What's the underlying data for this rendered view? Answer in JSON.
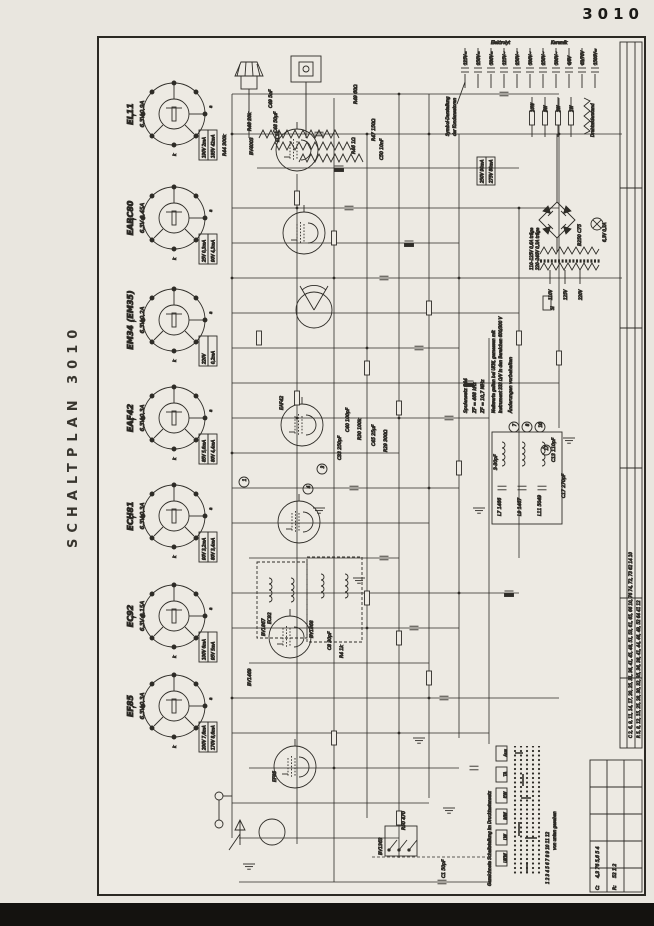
{
  "page": {
    "corner_number": "3010",
    "side_title": "SCHALTPLAN 3010"
  },
  "pins": {
    "f": "f",
    "k": "k",
    "a": "a"
  },
  "tubes": [
    {
      "name": "EL11",
      "heater": "6,3V 0,9A",
      "m1": "190V 2mA",
      "m2": "185V 42mA"
    },
    {
      "name": "EABC80",
      "heater": "6,3V 0,45A",
      "m1": "25V 0,3mA",
      "m2": "90V 4,3mA"
    },
    {
      "name": "EM34 (EM35)",
      "heater": "6,3V 0,2A",
      "m1": "220V",
      "m2": "0,2mA"
    },
    {
      "name": "EAF42",
      "heater": "6,3V 0,3A",
      "m1": "85V 5,6mA",
      "m2": "80V 4,4mA"
    },
    {
      "name": "ECH81",
      "heater": "6,3V 0,3A",
      "m1": "90V 3,2mA",
      "m2": "80V 3,4mA"
    },
    {
      "name": "EC92",
      "heater": "6,3V 0,15A",
      "m1": "100V 6mA",
      "m2": "95V 5mA"
    },
    {
      "name": "EF85",
      "heater": "6,3V 0,3A",
      "m1": "200V 7,6mA",
      "m2": "170V 8,6mA"
    }
  ],
  "legend": {
    "caps_title1": "Symbol-Darstellung",
    "caps_title2": "der Kondensatoren",
    "groups": [
      "Elektrolyt",
      "Keramik"
    ],
    "caps": [
      "125V=",
      "250V=",
      "500V=",
      "125V~",
      "250V~",
      "500V~",
      "250V~",
      "500V~",
      "6/8V",
      "63/70V",
      "1500V="
    ],
    "resistors": [
      "10W",
      "5W",
      "2W",
      "1W"
    ],
    "wire_resistor": "Drahtwiderstand"
  },
  "notes": {
    "spulensatz": "Spulensatz 544",
    "zf1": "ZF = 468 kHz",
    "zf2": "ZF = 10,7 MHz",
    "messung1": "Meßwerte gelten bei UKW, gemessen mit",
    "messung2": "Instrument 333 Ω/V in den Bereichen 600/300 V",
    "aenderungen": "Änderungen vorbehalten",
    "sicherung1": "110–125V 0,6A träge",
    "sicherung2": "220–240V 0,3A träge"
  },
  "power": {
    "rectifier": "B250 C75",
    "lamp": "6,3V 0,3A",
    "fuse": "Si",
    "taps": [
      "110V",
      "125V",
      "220V"
    ],
    "meas1": "250V 90mA",
    "meas2": "275V 80mA"
  },
  "switch_panel": {
    "title": "Gezeichnete Schaltstellung im Drucktastensatz",
    "buttons": [
      "Aus",
      "TA",
      "KW",
      "MW",
      "LW",
      "UKW"
    ],
    "row_numbers": "1 2 3 4 5 6 7 8 9 10 11 12",
    "footnote": "von unten gesehen"
  },
  "corner_table": {
    "c_label": "C:",
    "c_values": "4,3  76  5,6  5  4",
    "r_label": "R:",
    "r_values": "52  1  2"
  },
  "strip": {
    "line1": "C 2, 6, 9, 11, 14, 17, 20, 25, 31, 36, 41, 45, 48, 51, 53, 61, 65, 66    10, 76    74, 72, 73    62    14    10",
    "line2": "R 5, 8, 12, 15, 25, 28, 30, 32, 35, 36, 38, 41, 44, 46, 49, 52    64    41    12"
  },
  "junctions": [
    "1",
    "3",
    "4",
    "7",
    "8",
    "10",
    "17"
  ],
  "components": {
    "bv4003": "BV4003",
    "bv1868": "BV1868",
    "bv1867": "BV1867",
    "bv1469": "BV1469",
    "bv1363": "BV1363",
    "r44": "R44 300k",
    "r48": "R48 20k",
    "c49": "C49 5nF",
    "c48": "C48 50µF",
    "r49": "R49 60Ω",
    "r47": "R47 150Ω",
    "r46": "R46 1Ω",
    "c50": "C50 10nF",
    "c40": "C40 100pF",
    "r30": "R30 100k",
    "c45": "C45 25µF",
    "r29": "R29 300Ω",
    "c33": "C33 250pF",
    "c8": "C8 30pF",
    "r4": "R4 1k",
    "trim": "3-30pF",
    "l7": "L7 1466",
    "l9": "L9 1467",
    "l11": "L11 5049",
    "c13": "C13 110pF",
    "c17": "C17 270pF",
    "c1": "C1 50pF",
    "r50": "R50 470"
  }
}
